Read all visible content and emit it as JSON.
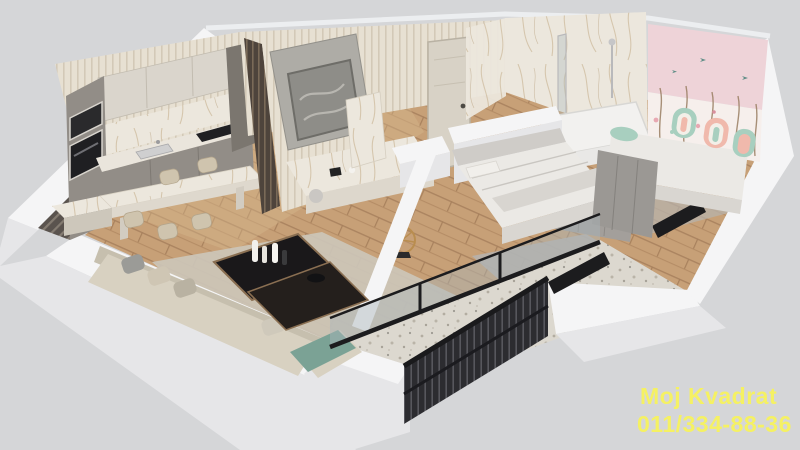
{
  "watermark": {
    "line1": "Moj Kvadrat",
    "line2": "011/334-88-36",
    "color": "#f5f163"
  },
  "palette": {
    "bg": "#d5d6d8",
    "wall_top": "#f5f5f6",
    "wall_face": "#e6e6e8",
    "wall_shadow": "#cfcfd2",
    "hatch_dark": "#5a534e",
    "slat_cream": "#e7e0d2",
    "marble": "#ece7dd",
    "marble_vein": "#c9b493",
    "wood": "#c7a077",
    "wood_light": "#d8b98f",
    "rug": "#ccc5b8",
    "rug_gray": "#b6b3af",
    "cabinet": "#928d87",
    "cabinet_dark": "#7b766f",
    "counter": "#eae5dc",
    "appliance": "#1f1f22",
    "sofa": "#d8d1c1",
    "sofa_shadow": "#c6bfae",
    "table_dark": "#1a181a",
    "table_wood": "#8a6f52",
    "bed": "#ebe9e5",
    "bed_shadow": "#d9d6d1",
    "headboard": "#cfccc8",
    "wardrobe": "#9b9894",
    "mural_pink": "#eed3d8",
    "mural_light": "#f6efec",
    "pillow_mint": "#a8cfbf",
    "pillow_pink": "#f0b9ac",
    "terrazzo": "#dcd8cf",
    "railing": "#2c2c30",
    "glass_frame": "#1c1c1e",
    "glass": "#aab6ba",
    "gold": "#b98d4f",
    "door": "#d8d2c6",
    "teal": "#7ba295",
    "oven_dark": "#2a2a2c"
  }
}
